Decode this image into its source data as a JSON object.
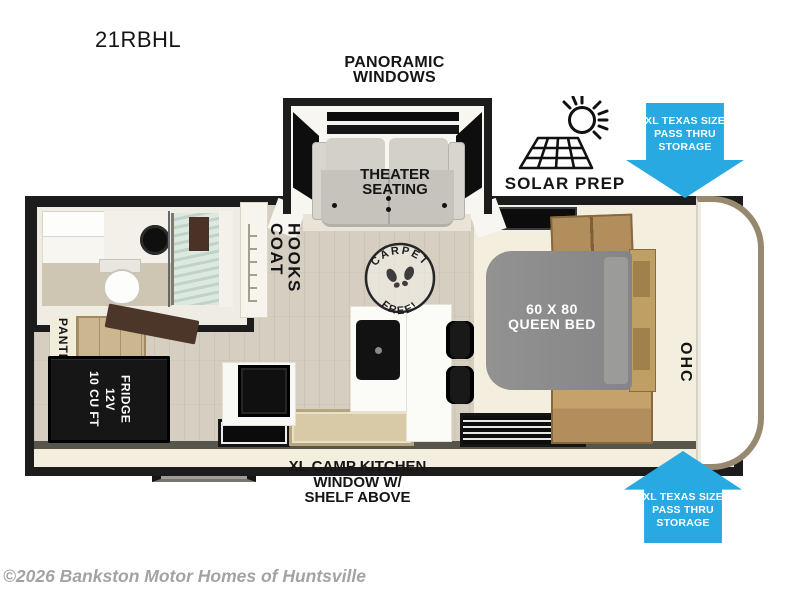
{
  "model": "21RBHL",
  "copyright": "©2026 Bankston Motor Homes of Huntsville",
  "colors": {
    "callout_blue": "#29a9e1",
    "wall_black": "#1c1c1c",
    "bed_gray": "#8c8c8a",
    "wood_cabinet": "#b28e5c"
  },
  "labels": {
    "panoramic_windows": {
      "line1": "PANORAMIC",
      "line2": "WINDOWS"
    },
    "theater_seating": {
      "line1": "THEATER",
      "line2": "SEATING"
    },
    "solar_prep": "SOLAR PREP",
    "pass_thru_storage": {
      "line1": "XL TEXAS SIZE",
      "line2": "PASS THRU",
      "line3": "STORAGE"
    },
    "coat_hooks": {
      "line1": "COAT",
      "line2": "HOOKS"
    },
    "carpet_free": {
      "top": "CARPET",
      "bottom": "FREE!"
    },
    "queen_bed": {
      "line1": "60 X 80",
      "line2": "QUEEN BED"
    },
    "ohc": "OHC",
    "pantry": "PANTRY",
    "fridge": {
      "line1": "10 CU FT",
      "line2": "12V",
      "line3": "FRIDGE"
    },
    "camp_kitchen": {
      "line1": "XL CAMP KITCHEN",
      "line2": "WINDOW W/",
      "line3": "SHELF ABOVE"
    }
  }
}
